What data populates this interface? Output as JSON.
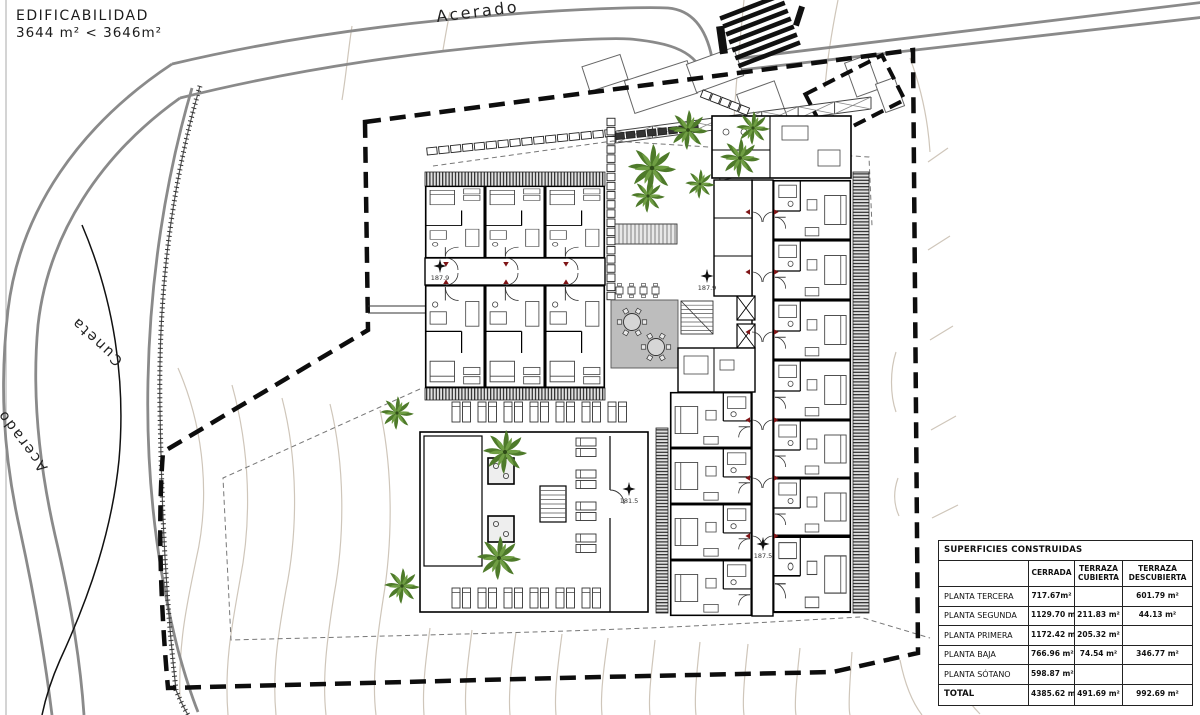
{
  "title_block": {
    "line1": "EDIFICABILIDAD",
    "line2": "3644 m²  <  3646m²"
  },
  "road_labels": {
    "top": "Acerado",
    "left_inner": "Cuneta",
    "left_outer": "Acerado"
  },
  "elevation_markers": [
    {
      "value": "187.9"
    },
    {
      "value": "187.9"
    },
    {
      "value": "181.5"
    },
    {
      "value": "187.5"
    }
  ],
  "areas_table": {
    "title": "SUPERFICIES CONSTRUIDAS",
    "columns": [
      "CERRADA",
      "TERRAZA CUBIERTA",
      "TERRAZA DESCUBIERTA"
    ],
    "rows": [
      {
        "label": "PLANTA TERCERA",
        "cerrada": "717.67m²",
        "terraza_cubierta": "",
        "terraza_descubierta": "601.79 m²"
      },
      {
        "label": "PLANTA SEGUNDA",
        "cerrada": "1129.70 m²",
        "terraza_cubierta": "211.83 m²",
        "terraza_descubierta": "44.13 m²"
      },
      {
        "label": "PLANTA PRIMERA",
        "cerrada": "1172.42 m²",
        "terraza_cubierta": "205.32 m²",
        "terraza_descubierta": ""
      },
      {
        "label": "PLANTA BAJA",
        "cerrada": "766.96 m²",
        "terraza_cubierta": "74.54 m²",
        "terraza_descubierta": "346.77 m²"
      },
      {
        "label": "PLANTA SÓTANO",
        "cerrada": "598.87 m²",
        "terraza_cubierta": "",
        "terraza_descubierta": ""
      },
      {
        "label": "TOTAL",
        "cerrada": "4385.62 m²",
        "terraza_cubierta": "491.69 m²",
        "terraza_descubierta": "992.69 m²"
      }
    ]
  },
  "colors": {
    "road_gray": "#8a8a8a",
    "contour_tan": "#cfc6ba",
    "boundary_black": "#0d0d0d",
    "terrace_gray": "#bdbdbd",
    "tree_green_dark": "#4e7a2a",
    "tree_green_light": "#6f9e43",
    "door_marker_red": "#7e1416"
  }
}
